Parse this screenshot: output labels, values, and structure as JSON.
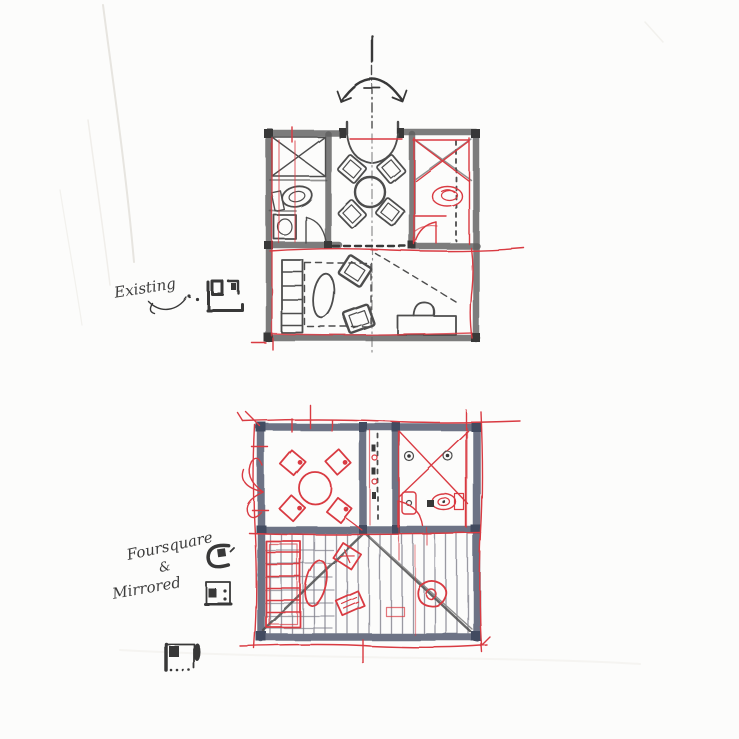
{
  "colors": {
    "paper": "#fcfcfb",
    "crease": "#e7e5e0",
    "pencil": "#4d4d4d",
    "pencil_soft": "#8f8f8f",
    "pencil_dark": "#373737",
    "wall_gray": "#5f5f5f",
    "wall_blue": "#5c6478",
    "wall_blue_dark": "#434b60",
    "hatch": "#80808c",
    "red_pen": "#d93a42",
    "ink": "#3c3c3c"
  },
  "labels": {
    "existing": "Existing",
    "scheme_line1": "Foursquare",
    "scheme_amp": "&",
    "scheme_line2": "Mirrored"
  },
  "plans": [
    {
      "id": "existing-plan",
      "caption": "Existing"
    },
    {
      "id": "foursquare-mirrored-plan",
      "caption": "Foursquare & Mirrored"
    }
  ],
  "icons": {
    "mirror-arrow-icon": "curved double-headed arrow over mirror axis centerline",
    "plan-thumbnail-existing-icon": "mini plan diagram, two cores flanking entry",
    "plan-thumbnail-rotated-icon": "mini plan diagram, rotated core",
    "plan-thumbnail-core-left-icon": "mini plan diagram, core at left with two dots",
    "plan-thumbnail-core-oval-icon": "mini plan diagram, core top-left and oval at right"
  }
}
